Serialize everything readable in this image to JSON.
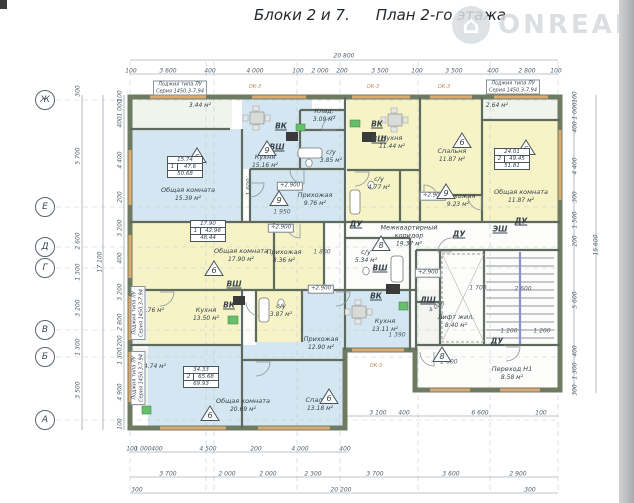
{
  "title_block": "Блоки 2 и 7.",
  "title_plan": "План 2-го этажа",
  "watermark": {
    "brand": "ONREALT",
    "logo_glyph": "⌂"
  },
  "colors": {
    "room_blue": "#d3e6f1",
    "room_yellow": "#f6f3c6",
    "room_pale": "#f0f4ec",
    "room_white": "#fcfcfa",
    "closet": "#f4f4f0",
    "wall": "#6f7a62",
    "window": "#dca96f",
    "dim_line": "#7d8b97",
    "dash_line": "#c3cdd4",
    "stair_accent": "#8890cf",
    "green_fixture": "#66bf6a",
    "dark_fixture": "#3a3a3a"
  },
  "plan": {
    "rooms": [
      {
        "id": "loggia1",
        "name": "",
        "area": "3.44 м²",
        "color": "pale",
        "rect": [
          132,
          99,
          100,
          30
        ],
        "label": [
          200,
          106
        ]
      },
      {
        "id": "common1",
        "name": "Общая комната",
        "area": "15.39 м²",
        "color": "blue",
        "rect": [
          132,
          129,
          110,
          93
        ],
        "label": [
          188,
          195
        ]
      },
      {
        "id": "kitchen1",
        "name": "Кухня",
        "area": "15.16 м²",
        "color": "blue",
        "rect": [
          242,
          99,
          70,
          70
        ],
        "label": [
          265,
          162
        ]
      },
      {
        "id": "storage1",
        "name": "Клад.",
        "area": "3.09 м²",
        "color": "blue",
        "rect": [
          298,
          110,
          47,
          20
        ],
        "label": [
          324,
          116
        ]
      },
      {
        "id": "bath1",
        "name": "с/у",
        "area": "3.85 м²",
        "color": "blue",
        "rect": [
          298,
          130,
          47,
          39
        ],
        "label": [
          331,
          157
        ]
      },
      {
        "id": "hall1",
        "name": "Прихожая",
        "area": "9.76 м²",
        "color": "blue",
        "rect": [
          250,
          169,
          95,
          53
        ],
        "label": [
          315,
          200
        ]
      },
      {
        "id": "kitchen2",
        "name": "Кухня",
        "area": "11.44 м²",
        "color": "yellow",
        "rect": [
          347,
          99,
          73,
          71
        ],
        "label": [
          392,
          143
        ]
      },
      {
        "id": "bath2",
        "name": "с/у",
        "area": "4.77 м²",
        "color": "yellow",
        "rect": [
          347,
          170,
          53,
          52
        ],
        "label": [
          379,
          184
        ]
      },
      {
        "id": "hall2gap",
        "name": "",
        "area": "",
        "color": "yellow",
        "rect": [
          400,
          170,
          20,
          52
        ],
        "label": [
          0,
          0
        ]
      },
      {
        "id": "bedroom2",
        "name": "Спальня",
        "area": "11.87 м²",
        "color": "yellow",
        "rect": [
          420,
          99,
          62,
          96
        ],
        "label": [
          452,
          156
        ]
      },
      {
        "id": "hall2",
        "name": "Прихожая",
        "area": "9.23 м²",
        "color": "yellow",
        "rect": [
          420,
          195,
          62,
          27
        ],
        "label": [
          458,
          201
        ]
      },
      {
        "id": "common2",
        "name": "Общая комната",
        "area": "11.87 м²",
        "color": "yellow",
        "rect": [
          482,
          120,
          78,
          102
        ],
        "label": [
          521,
          197
        ]
      },
      {
        "id": "loggia2",
        "name": "",
        "area": "2.64 м²",
        "color": "pale",
        "rect": [
          482,
          99,
          78,
          21
        ],
        "label": [
          497,
          106
        ]
      },
      {
        "id": "common3",
        "name": "Общая комната",
        "area": "17.90 м²",
        "color": "yellow",
        "rect": [
          132,
          222,
          142,
          68
        ],
        "label": [
          241,
          256
        ]
      },
      {
        "id": "hall3",
        "name": "Прихожая",
        "area": "8.36 м²",
        "color": "yellow",
        "rect": [
          274,
          222,
          50,
          68
        ],
        "label": [
          284,
          257
        ]
      },
      {
        "id": "kitchen3",
        "name": "Кухня",
        "area": "13.50 м²",
        "color": "yellow",
        "rect": [
          148,
          290,
          92,
          56
        ],
        "label": [
          206,
          315
        ]
      },
      {
        "id": "hall4",
        "name": "Прихожая",
        "area": "12.90 м²",
        "color": "blue",
        "rect": [
          242,
          290,
          103,
          70
        ],
        "label": [
          321,
          344
        ]
      },
      {
        "id": "bath3",
        "name": "с/у",
        "area": "3.87 м²",
        "color": "yellow",
        "rect": [
          256,
          290,
          46,
          52
        ],
        "label": [
          281,
          311
        ]
      },
      {
        "id": "shaftgap",
        "name": "",
        "area": "",
        "color": "white",
        "rect": [
          240,
          290,
          16,
          55
        ],
        "label": [
          0,
          0
        ]
      },
      {
        "id": "loggia3",
        "name": "",
        "area": "2.76 м²",
        "color": "pale",
        "rect": [
          132,
          292,
          16,
          52
        ],
        "label": [
          153,
          311
        ]
      },
      {
        "id": "common4",
        "name": "Общая комната",
        "area": "20.69 м²",
        "color": "blue",
        "rect": [
          148,
          345,
          94,
          83
        ],
        "label": [
          243,
          406
        ]
      },
      {
        "id": "loggia4",
        "name": "",
        "area": "4.74 м²",
        "color": "pale",
        "rect": [
          132,
          348,
          16,
          58
        ],
        "label": [
          155,
          367
        ]
      },
      {
        "id": "bedroom4",
        "name": "Спальня",
        "area": "13.18 м²",
        "color": "blue",
        "rect": [
          242,
          360,
          103,
          68
        ],
        "label": [
          320,
          405
        ]
      },
      {
        "id": "kitchen4",
        "name": "Кухня",
        "area": "13.11 м²",
        "color": "blue",
        "rect": [
          345,
          290,
          65,
          60
        ],
        "label": [
          385,
          326
        ]
      },
      {
        "id": "bath4",
        "name": "с/у",
        "area": "5.34 м²",
        "color": "blue",
        "rect": [
          345,
          238,
          55,
          52
        ],
        "label": [
          366,
          257
        ]
      },
      {
        "id": "corridor",
        "name": "Межквартирный коридор",
        "area": "19.37 м²",
        "color": "white",
        "rect": [
          324,
          222,
          236,
          68
        ],
        "label": [
          409,
          236
        ],
        "wrap": 64
      },
      {
        "id": "stairbg",
        "name": "",
        "area": "",
        "color": "white",
        "rect": [
          416,
          250,
          144,
          95
        ],
        "label": [
          0,
          0
        ]
      },
      {
        "id": "closet-du",
        "name": "",
        "area": "",
        "color": "closet",
        "rect": [
          416,
          290,
          24,
          60
        ],
        "label": [
          0,
          0
        ]
      },
      {
        "id": "lift",
        "name": "Лифт жил.",
        "area": "8.40 м²",
        "color": "white",
        "rect": [
          440,
          252,
          44,
          92
        ],
        "label": [
          456,
          322
        ]
      },
      {
        "id": "perehod",
        "name": "Переход Н1",
        "area": "8.58 м²",
        "color": "white",
        "rect": [
          417,
          350,
          141,
          38
        ],
        "label": [
          512,
          374
        ]
      }
    ],
    "balcony_notes": [
      {
        "lines": [
          "Лоджия типа ЛУ",
          "Серия 1450.3-7.94"
        ],
        "x": 180,
        "y": 88,
        "rot": 0
      },
      {
        "lines": [
          "Лоджия типа ЛУ",
          "Серия 1450.3-7.94"
        ],
        "x": 513,
        "y": 87,
        "rot": 0
      },
      {
        "lines": [
          "Лоджия типа ЛУ",
          "Серия 1450.3-7.94"
        ],
        "x": 138,
        "y": 313,
        "rot": -90
      },
      {
        "lines": [
          "Лоджия типа ЛУ",
          "Серия 1450.3-7.94"
        ],
        "x": 138,
        "y": 378,
        "rot": -90
      }
    ],
    "window_tags": [
      {
        "text": "ОК-3",
        "x": 255,
        "y": 87
      },
      {
        "text": "ОК-3",
        "x": 373,
        "y": 87
      },
      {
        "text": "ОК-3",
        "x": 444,
        "y": 87
      },
      {
        "text": "ОК-3",
        "x": 376,
        "y": 366
      }
    ],
    "shafts": [
      {
        "text": "ВК",
        "x": 281,
        "y": 126
      },
      {
        "text": "ВШ",
        "x": 277,
        "y": 147
      },
      {
        "text": "ВК",
        "x": 377,
        "y": 124
      },
      {
        "text": "ВШ",
        "x": 379,
        "y": 139
      },
      {
        "text": "ВШ",
        "x": 234,
        "y": 284
      },
      {
        "text": "ВК",
        "x": 229,
        "y": 305
      },
      {
        "text": "ВШ",
        "x": 380,
        "y": 268
      },
      {
        "text": "ВК",
        "x": 376,
        "y": 296
      },
      {
        "text": "ДУ",
        "x": 356,
        "y": 224
      },
      {
        "text": "ДУ",
        "x": 521,
        "y": 221
      },
      {
        "text": "ЭШ",
        "x": 500,
        "y": 229
      },
      {
        "text": "ДУ",
        "x": 459,
        "y": 234
      },
      {
        "text": "ЛШ",
        "x": 428,
        "y": 300
      },
      {
        "text": "ДУ",
        "x": 497,
        "y": 341
      }
    ],
    "levels": [
      {
        "text": "+2.900",
        "x": 290,
        "y": 186
      },
      {
        "text": "+2.900",
        "x": 281,
        "y": 228
      },
      {
        "text": "+2.900",
        "x": 433,
        "y": 196
      },
      {
        "text": "+2.900",
        "x": 321,
        "y": 289
      },
      {
        "text": "+2.900",
        "x": 428,
        "y": 273
      }
    ],
    "badges": [
      {
        "n": "6",
        "x": 187,
        "y": 147
      },
      {
        "n": "9",
        "x": 257,
        "y": 140
      },
      {
        "n": "9",
        "x": 269,
        "y": 190
      },
      {
        "n": "6",
        "x": 452,
        "y": 132
      },
      {
        "n": "9",
        "x": 436,
        "y": 183
      },
      {
        "n": "6",
        "x": 516,
        "y": 139
      },
      {
        "n": "6",
        "x": 204,
        "y": 260
      },
      {
        "n": "8",
        "x": 371,
        "y": 235
      },
      {
        "n": "6",
        "x": 319,
        "y": 388
      },
      {
        "n": "6",
        "x": 200,
        "y": 405
      },
      {
        "n": "8",
        "x": 432,
        "y": 346
      }
    ],
    "area_tables": [
      {
        "rooms": "1",
        "values": [
          "15.74",
          "47.6",
          "50.68"
        ],
        "x": 185,
        "y": 167
      },
      {
        "rooms": "2",
        "values": [
          "24.01",
          "49.45",
          "51.81"
        ],
        "x": 512,
        "y": 159
      },
      {
        "rooms": "1",
        "values": [
          "17.90",
          "42.96",
          "48.44"
        ],
        "x": 208,
        "y": 231
      },
      {
        "rooms": "2",
        "values": [
          "34.33",
          "65.68",
          "69.93"
        ],
        "x": 201,
        "y": 377
      }
    ],
    "axes": [
      {
        "letter": "Ж",
        "y": 100
      },
      {
        "letter": "Е",
        "y": 207
      },
      {
        "letter": "Д",
        "y": 247
      },
      {
        "letter": "Г",
        "y": 268
      },
      {
        "letter": "В",
        "y": 330
      },
      {
        "letter": "Б",
        "y": 357
      },
      {
        "letter": "А",
        "y": 420
      }
    ],
    "overall_dims": {
      "top": "20 800",
      "bottom": "20 200",
      "left": "17 100",
      "right": "15 600"
    },
    "dim_labels": [
      [
        "20 800",
        344,
        56,
        0
      ],
      [
        "100",
        131,
        71,
        0
      ],
      [
        "3 600",
        168,
        71,
        0
      ],
      [
        "400",
        210,
        71,
        0
      ],
      [
        "4 000",
        255,
        71,
        0
      ],
      [
        "100",
        298,
        71,
        0
      ],
      [
        "2 000",
        320,
        71,
        0
      ],
      [
        "200",
        342,
        71,
        0
      ],
      [
        "3 500",
        380,
        71,
        0
      ],
      [
        "100",
        417,
        71,
        0
      ],
      [
        "3 500",
        454,
        71,
        0
      ],
      [
        "400",
        493,
        71,
        0
      ],
      [
        "2 800",
        527,
        71,
        0
      ],
      [
        "100",
        556,
        71,
        0
      ],
      [
        "100",
        132,
        449,
        0
      ],
      [
        "1 000",
        143,
        449,
        0
      ],
      [
        "400",
        157,
        449,
        0
      ],
      [
        "4 500",
        208,
        449,
        0
      ],
      [
        "200",
        256,
        449,
        0
      ],
      [
        "4 000",
        300,
        449,
        0
      ],
      [
        "400",
        345,
        449,
        0
      ],
      [
        "3 100",
        378,
        413,
        0
      ],
      [
        "400",
        404,
        413,
        0
      ],
      [
        "6 600",
        480,
        413,
        0
      ],
      [
        "100",
        541,
        413,
        0
      ],
      [
        "3 700",
        168,
        474,
        0
      ],
      [
        "2 000",
        227,
        474,
        0
      ],
      [
        "2 000",
        268,
        474,
        0
      ],
      [
        "2 300",
        313,
        474,
        0
      ],
      [
        "3 700",
        375,
        474,
        0
      ],
      [
        "3 600",
        451,
        474,
        0
      ],
      [
        "2 900",
        518,
        474,
        0
      ],
      [
        "300",
        137,
        490,
        0
      ],
      [
        "20 200",
        341,
        490,
        0
      ],
      [
        "300",
        530,
        490,
        0
      ],
      [
        "300",
        78,
        91,
        -90
      ],
      [
        "5 700",
        78,
        156,
        -90
      ],
      [
        "2 600",
        78,
        241,
        -90
      ],
      [
        "1 300",
        78,
        272,
        -90
      ],
      [
        "3 200",
        78,
        308,
        -90
      ],
      [
        "1 300",
        78,
        347,
        -90
      ],
      [
        "3 500",
        78,
        390,
        -90
      ],
      [
        "17 100",
        100,
        262,
        -90
      ],
      [
        "100",
        120,
        96,
        -90
      ],
      [
        "1 000",
        120,
        108,
        -90
      ],
      [
        "400",
        120,
        122,
        -90
      ],
      [
        "4 400",
        120,
        160,
        -90
      ],
      [
        "200",
        120,
        197,
        -90
      ],
      [
        "3 200",
        120,
        228,
        -90
      ],
      [
        "400",
        120,
        258,
        -90
      ],
      [
        "3 200",
        120,
        292,
        -90
      ],
      [
        "2 800",
        120,
        322,
        -90
      ],
      [
        "200",
        120,
        341,
        -90
      ],
      [
        "1 300",
        120,
        356,
        -90
      ],
      [
        "4 900",
        120,
        392,
        -90
      ],
      [
        "100",
        120,
        424,
        -90
      ],
      [
        "100",
        575,
        97,
        -90
      ],
      [
        "1 000",
        575,
        111,
        -90
      ],
      [
        "400",
        575,
        127,
        -90
      ],
      [
        "4 400",
        575,
        166,
        -90
      ],
      [
        "300",
        575,
        197,
        -90
      ],
      [
        "1 500",
        575,
        220,
        -90
      ],
      [
        "200",
        575,
        241,
        -90
      ],
      [
        "5 600",
        575,
        300,
        -90
      ],
      [
        "400",
        575,
        351,
        -90
      ],
      [
        "1 300",
        575,
        371,
        -90
      ],
      [
        "300",
        575,
        390,
        -90
      ],
      [
        "15 600",
        596,
        245,
        -90
      ],
      [
        "1 600",
        249,
        187,
        -90
      ],
      [
        "1 950",
        282,
        212,
        0
      ],
      [
        "1 800",
        322,
        252,
        0
      ],
      [
        "4 000",
        437,
        307,
        -27
      ],
      [
        "1 700",
        478,
        288,
        0
      ],
      [
        "2 600",
        523,
        289,
        0
      ],
      [
        "1 200",
        509,
        331,
        0
      ],
      [
        "1 200",
        542,
        331,
        0
      ],
      [
        "2 600",
        449,
        362,
        0
      ],
      [
        "1 390",
        397,
        335,
        0
      ]
    ]
  }
}
